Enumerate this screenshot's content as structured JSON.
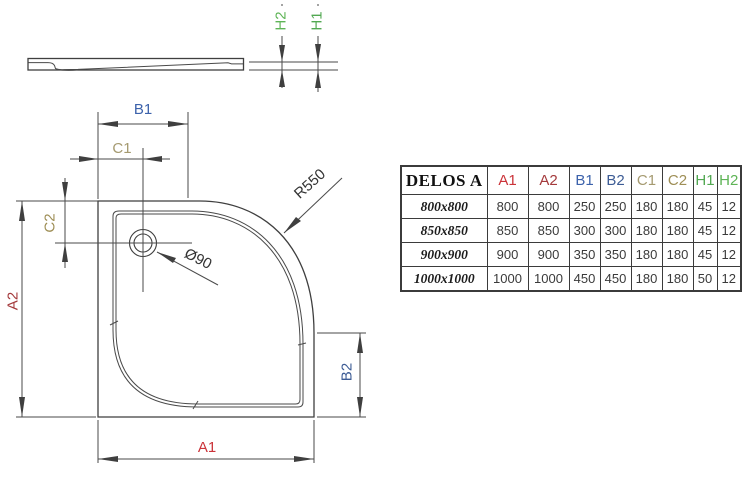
{
  "drawing": {
    "side_view_labels": {
      "h2": "H2",
      "h1": "H1"
    },
    "top_view_labels": {
      "b1": "B1",
      "c1": "C1",
      "c2": "C2",
      "a2": "A2",
      "a1": "A1",
      "b2": "B2"
    },
    "annotations": {
      "radius": "R550",
      "drain_diameter": "Ø90"
    },
    "colors": {
      "a1": "#cb3339",
      "a2": "#a43a3c",
      "b1": "#3c62ab",
      "b2": "#3d5c95",
      "c1": "#a59a70",
      "c2": "#9e8e55",
      "h1": "#52a852",
      "h2": "#5eb456",
      "line": "#3f3f3f"
    }
  },
  "table": {
    "title": "DELOS A",
    "columns": [
      {
        "label": "A1",
        "color": "#cb3339"
      },
      {
        "label": "A2",
        "color": "#a43a3c"
      },
      {
        "label": "B1",
        "color": "#3c62ab"
      },
      {
        "label": "B2",
        "color": "#3d5c95"
      },
      {
        "label": "C1",
        "color": "#a59a70"
      },
      {
        "label": "C2",
        "color": "#9e8e55"
      },
      {
        "label": "H1",
        "color": "#52a852"
      },
      {
        "label": "H2",
        "color": "#5eb456"
      }
    ],
    "rows": [
      {
        "size": "800x800",
        "values": [
          "800",
          "800",
          "250",
          "250",
          "180",
          "180",
          "45",
          "12"
        ]
      },
      {
        "size": "850x850",
        "values": [
          "850",
          "850",
          "300",
          "300",
          "180",
          "180",
          "45",
          "12"
        ]
      },
      {
        "size": "900x900",
        "values": [
          "900",
          "900",
          "350",
          "350",
          "180",
          "180",
          "45",
          "12"
        ]
      },
      {
        "size": "1000x1000",
        "values": [
          "1000",
          "1000",
          "450",
          "450",
          "180",
          "180",
          "50",
          "12"
        ]
      }
    ]
  }
}
